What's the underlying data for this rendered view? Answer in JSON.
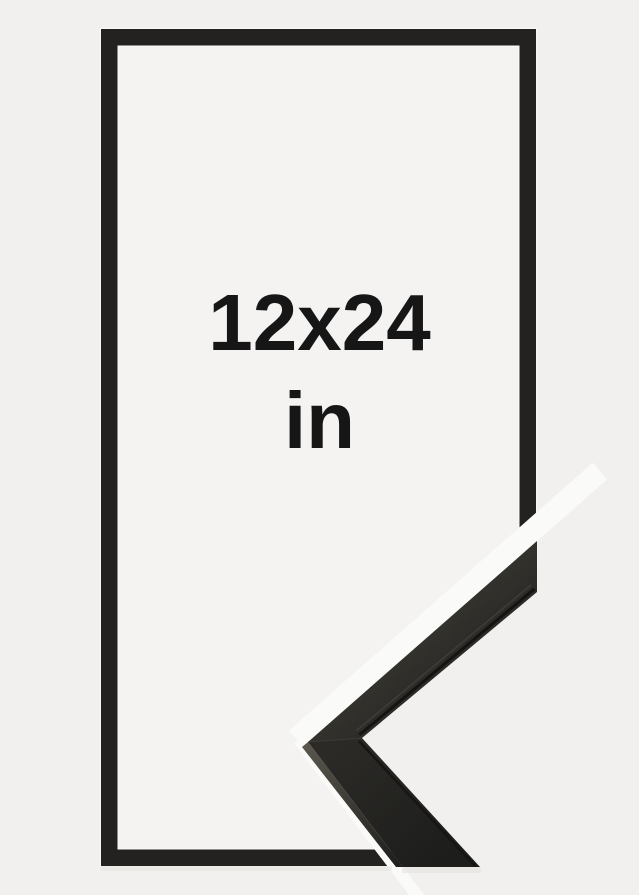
{
  "product": {
    "size_value": "12x24",
    "size_unit": "in",
    "colors": {
      "background": "#f1f0ee",
      "inner_area": "#f4f3f1",
      "outline": "#232221",
      "halo": "#ffffff",
      "gap_white": "#fafaf8",
      "text": "#161616",
      "moulding_light": "#36352f",
      "moulding_mid": "#2b2a27",
      "moulding_dark": "#1d1d1b",
      "side_light": "#5a574d",
      "shadow": "#e4e3e0"
    }
  }
}
